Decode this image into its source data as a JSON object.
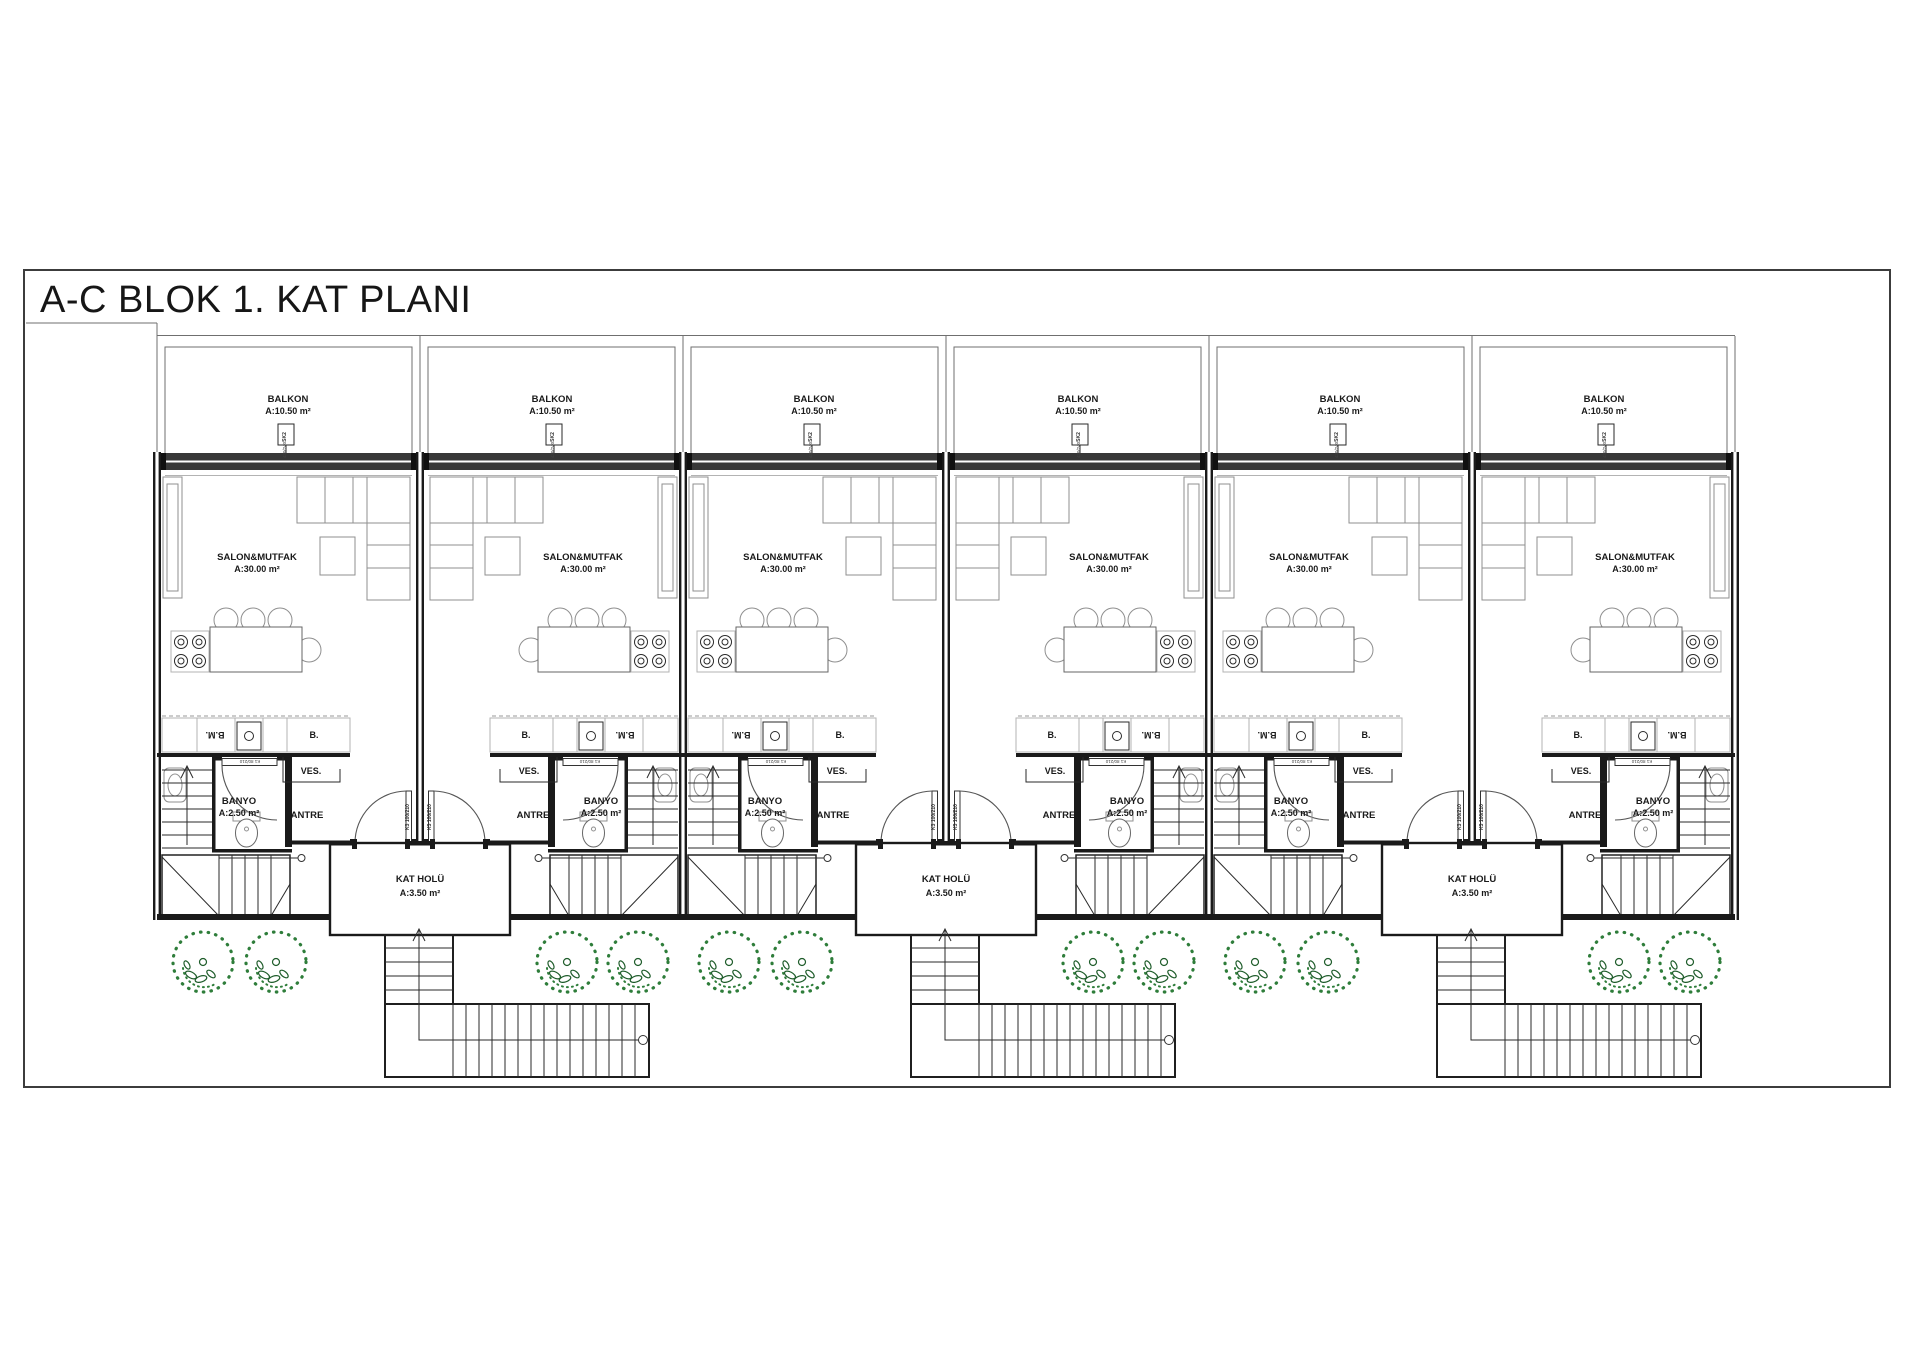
{
  "page": {
    "title": "A-C BLOK 1. KAT PLANI"
  },
  "unit_labels": {
    "balkon_name": "BALKON",
    "balkon_area": "A:10.50 m²",
    "window_tag": "SK2",
    "window_dims": "430/240",
    "salon_name": "SALON&MUTFAK",
    "salon_area": "A:30.00 m²",
    "counter_bm": "B.M.",
    "counter_b": "B.",
    "ves": "VES.",
    "banyo_name": "BANYO",
    "banyo_area": "A:2.50 m²",
    "banyo_door_tag": "K1 80/210",
    "hall_door_tag": "K3 100/210",
    "antre": "ANTRE"
  },
  "hall_labels": {
    "name": "KAT HOLÜ",
    "area": "A:3.50 m²"
  },
  "colors": {
    "tree": "#2e7d3a",
    "tree_dark": "#1e5c2a",
    "line": "#1a1a1a",
    "band": "#383838"
  }
}
